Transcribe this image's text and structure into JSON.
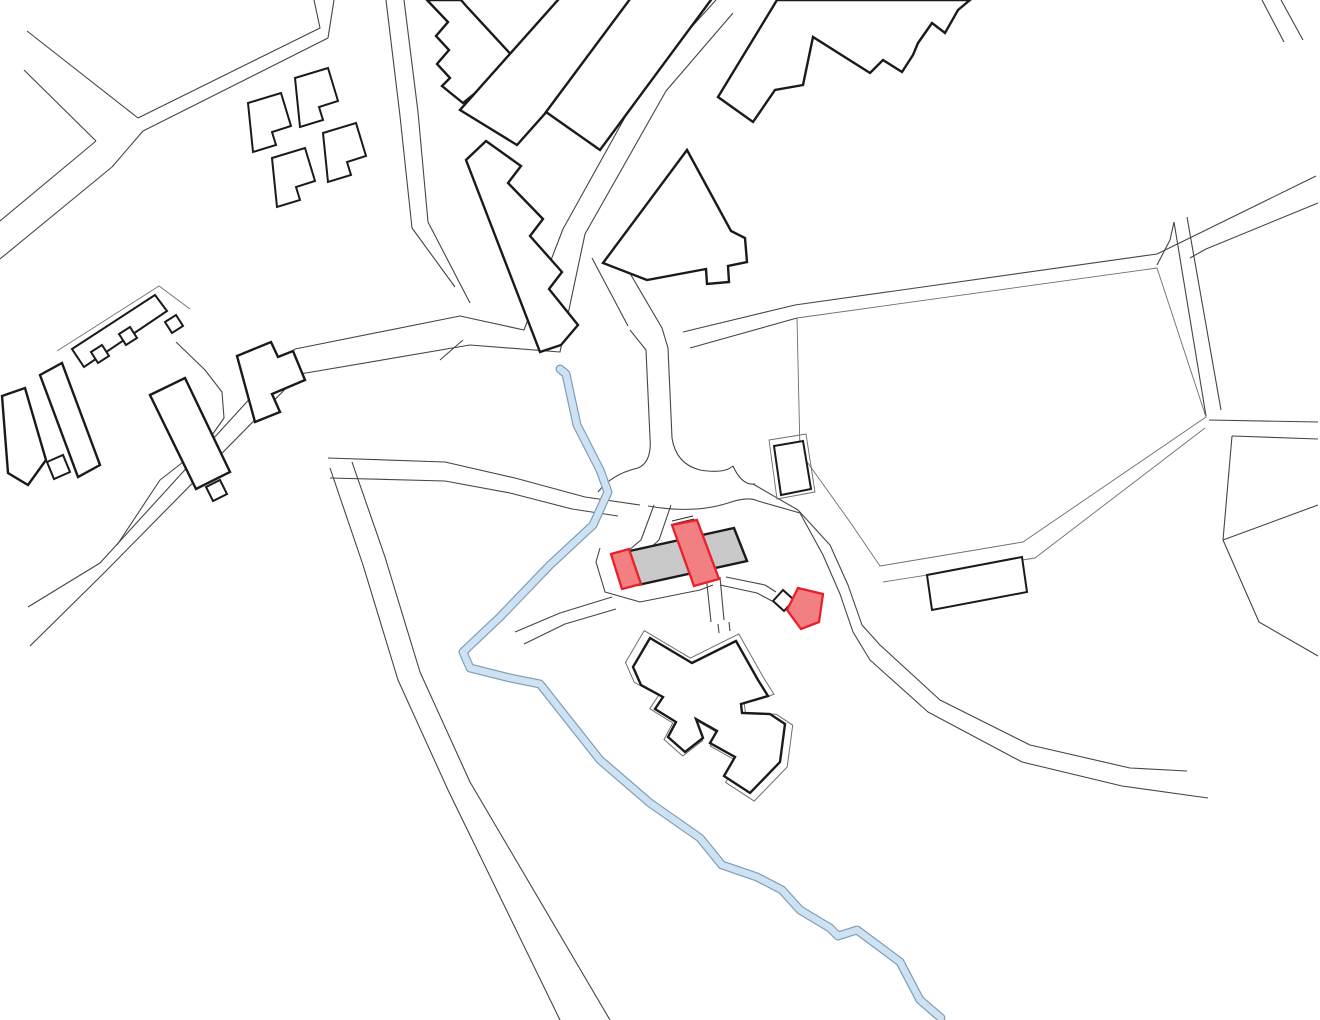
{
  "page": {
    "title": "Architectural site plan",
    "type": "vector line drawing, no text labels"
  },
  "colors": {
    "background": "#ffffff",
    "road": "#454545",
    "thin_outline": "#6e6e6e",
    "outline": "#1a1a1a",
    "existing_fill": "#c9c9c9",
    "highlight_fill": "#f28083",
    "highlight_stroke": "#e8202a",
    "water_fill": "#cfe2f3",
    "water_edge": "#7e9eb5"
  },
  "features": {
    "highlighted_buildings": [
      {
        "id": "west-annex",
        "shape": "small slanted rectangle",
        "fill": "red"
      },
      {
        "id": "main-hall",
        "shape": "large slanted rectangle crossing the gray building",
        "fill": "red"
      },
      {
        "id": "pavilion",
        "shape": "pentagon with attached white square kiosk",
        "fill": "red"
      }
    ],
    "existing_site_building": {
      "id": "gray-building",
      "shape": "long slanted rectangle",
      "fill": "gray"
    },
    "church_complex": {
      "id": "church-complex",
      "shape": "irregular polygon with thin offset outline",
      "fill": "white"
    },
    "stream": {
      "id": "stream",
      "color": "light blue",
      "course": "from upper centre curving to bottom centre"
    },
    "context": {
      "housing_cluster": "small L-shaped cottages upper left",
      "large_blocks": "two slanted rectangular blocks and triangular building top centre",
      "jagged_building": "stepped outline building top right",
      "sports_field": "large open parcel on the right",
      "roads": "thin double-line street network"
    }
  }
}
